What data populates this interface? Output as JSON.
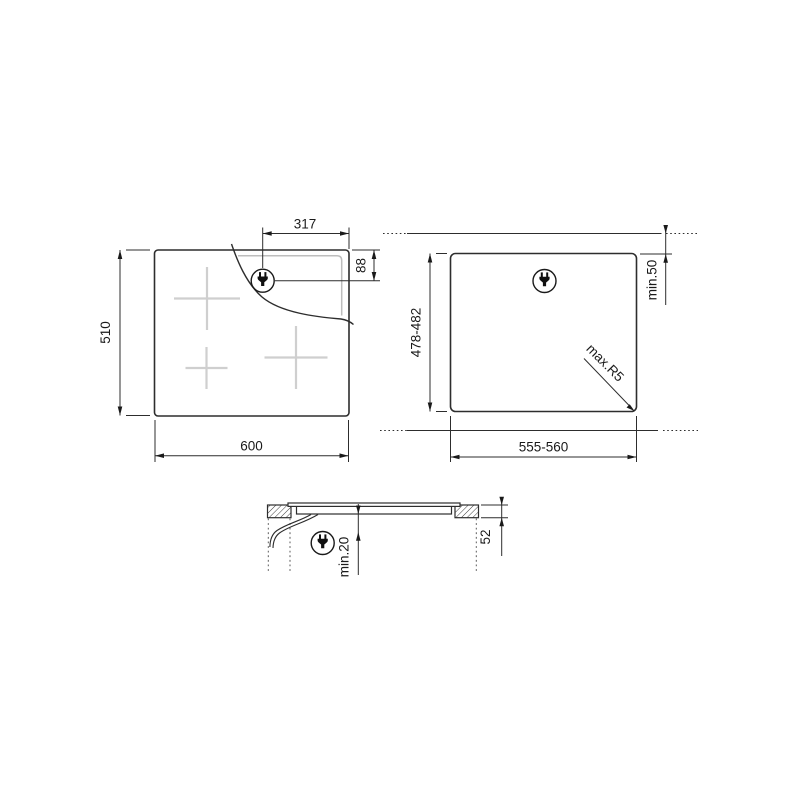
{
  "title": "built-in hob installation drawing",
  "colors": {
    "line": "#2d2d2d",
    "light_gray": "#cfcfcf",
    "background": "#ffffff"
  },
  "top_view": {
    "description": "hob seen from above",
    "width_label": "600",
    "height_label": "510",
    "plug_offset_x_label": "317",
    "plug_offset_y_label": "88",
    "plug_icon": "power-plug-icon"
  },
  "cutout_view": {
    "description": "worktop cutout seen from above",
    "width_label": "555-560",
    "height_label": "478-482",
    "rear_clearance_label": "min.50",
    "corner_radius_label": "max.R5",
    "plug_icon": "power-plug-icon"
  },
  "side_view": {
    "description": "installed hob cross-section",
    "hob_height_label": "52",
    "bottom_clearance_label": "min.20",
    "plug_icon": "power-plug-icon"
  }
}
